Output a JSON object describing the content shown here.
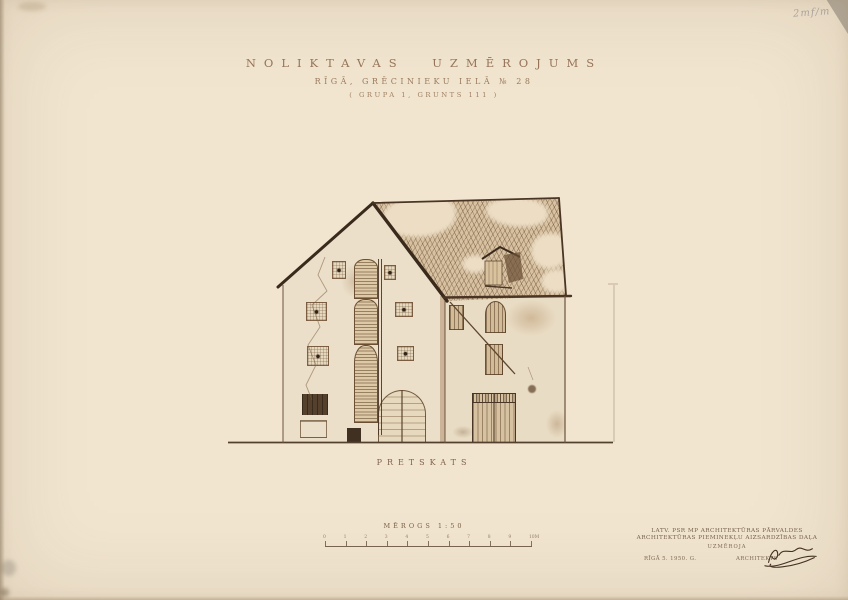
{
  "colors": {
    "paper": "#f1e5d0",
    "ink": "#6b4f37",
    "wall": "#ebdfc9",
    "roof": "#d7c1a1",
    "dark_wood": "#4a3626",
    "title": "#97755a"
  },
  "title_block": {
    "line1": "NOLIKTAVAS UZMĒROJUMS",
    "line2": "RĪGĀ, GRĒCINIEKU IELĀ № 28",
    "line3": "( GRUPA 1, GRUNTS 111 )"
  },
  "archival_note": "2mf/m 5",
  "view_label": "PRETSKATS",
  "scale": {
    "label": "MĒROGS 1:50",
    "ticks": [
      "0",
      "1",
      "2",
      "3",
      "4",
      "5",
      "6",
      "7",
      "8",
      "9",
      "10M"
    ]
  },
  "credits": {
    "line1": "LATV. PSR MP ARCHITEKTŪRAS PĀRVALDES",
    "line2": "ARCHITEKTŪRAS PIEMINEKĻU AIZSARDZĪBAS DAĻA",
    "line3": "UZMĒROJA",
    "place_date": "RĪGĀ 5. 1950. G.",
    "role": "ARCHITEKTS",
    "signature_icon": "signature-scribble-icon"
  },
  "drawing": {
    "subject": "Front elevation of a gabled warehouse: central stacked hoist hatches with louvred shutters, latticed windows, tiled roof with open dormer hatch, arched entrance door and plank gate"
  }
}
